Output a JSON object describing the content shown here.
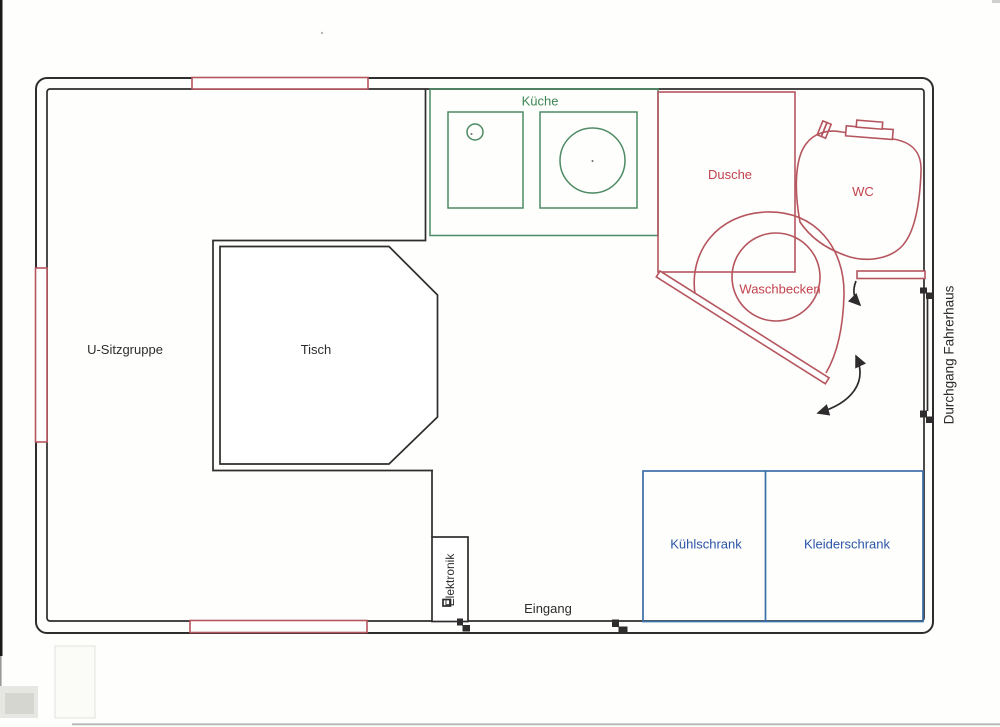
{
  "page": {
    "type": "scanned floor plan",
    "language": "de"
  },
  "colors": {
    "ink": "#2e2c2c",
    "red": "#b5555e",
    "red_text": "#c2424e",
    "green": "#4c8a64",
    "green_text": "#3f8656",
    "blue": "#3a6ea8",
    "blue_text": "#2b55a8",
    "paper": "#fefefc"
  },
  "labels": {
    "seating": "U-Sitzgruppe",
    "table": "Tisch",
    "kitchen": "Küche",
    "shower": "Dusche",
    "toilet": "WC",
    "washbasin": "Waschbecken",
    "fridge": "Kühlschrank",
    "wardrobe": "Kleiderschrank",
    "electronics": "Elektronik",
    "entrance": "Eingang",
    "cab_passage": "Durchgang Fahrerhaus"
  }
}
